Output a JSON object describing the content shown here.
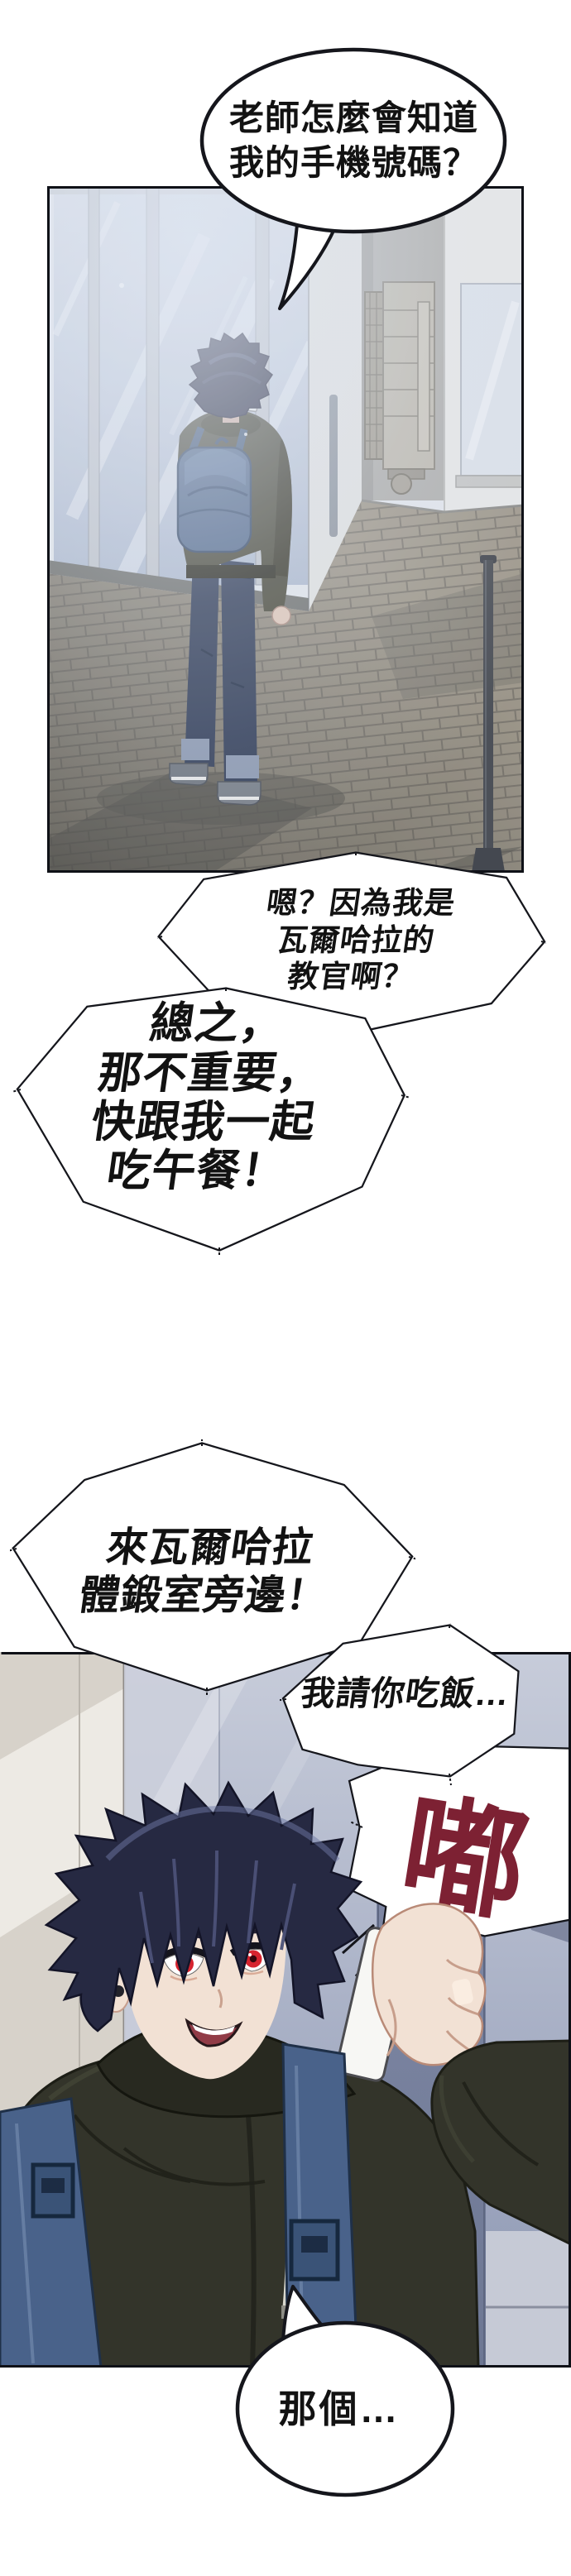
{
  "comic": {
    "bubbles": {
      "teacher_phone": {
        "lines": [
          "老師怎麼會知道",
          "我的手機號碼？"
        ]
      },
      "instructor": {
        "lines": [
          "嗯？因為我是",
          "瓦爾哈拉的",
          "教官啊？"
        ]
      },
      "lunch": {
        "lines": [
          "總之，",
          "那不重要，",
          "快跟我一起",
          "吃午餐！"
        ]
      },
      "gym": {
        "lines": [
          "來瓦爾哈拉",
          "體鍛室旁邊！"
        ]
      },
      "treat": {
        "lines": [
          "我請你吃飯…"
        ]
      },
      "that": {
        "lines": [
          "那個…"
        ]
      }
    },
    "sfx": {
      "text": "嘟",
      "color": "#7d2133"
    },
    "colors": {
      "bubble_fill": "#ffffff",
      "bubble_stroke": "#15161c",
      "text": "#121212",
      "sfx_red": "#7d2133",
      "eye_red": "#d6242f",
      "hair_navy": "#262942",
      "hoodie_green": "#33342a",
      "backpack_blue": "#49628a",
      "panel1_haze": "#ccd3e0",
      "panel2_wall": "#a3adc6"
    }
  }
}
